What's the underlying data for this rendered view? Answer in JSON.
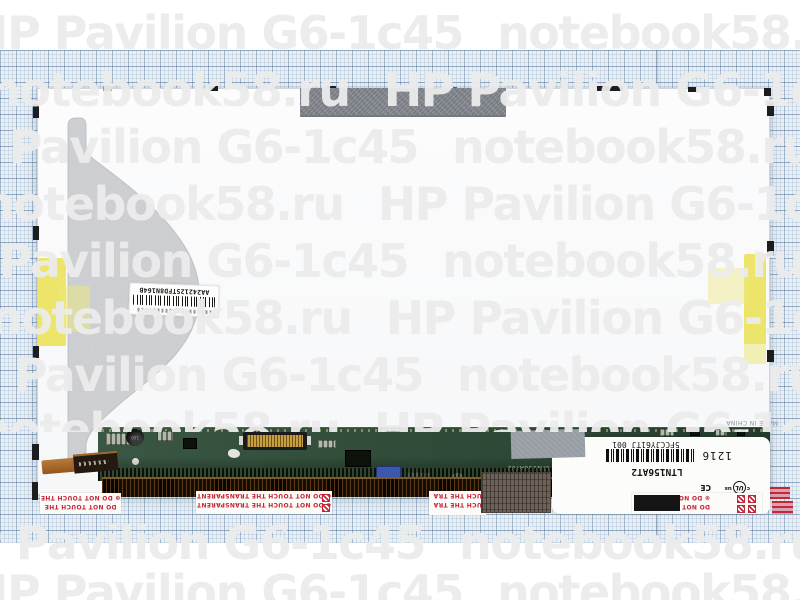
{
  "watermark": {
    "product": "HP Pavilion G6-1c45",
    "site": "notebook58.ru"
  },
  "labels": {
    "backing_barcode_text": "AA24212STFD8N164B",
    "model": "LTN156AT2",
    "serial": "5FCCJY61TJ 001",
    "date_code": "1216",
    "made_in": "MADE IN CHINA",
    "ul_c": "c",
    "ul_core": "UL",
    "ul_us": "us",
    "ce": "CE",
    "pcb_silkscreen": "LTN156AT02",
    "inductor_value": "100"
  },
  "warnings": {
    "short_star": "⊛ DO NOT TOUCH THE",
    "short": "DO NOT TOUCH THE",
    "full": "⊛ DO NOT TOUCH THE TRANSPARENT",
    "frag_mid": "UCH THE TRA",
    "frag_right": "⊛ DO NOT TOUC",
    "frag_right2": "DO NOT TOU"
  }
}
